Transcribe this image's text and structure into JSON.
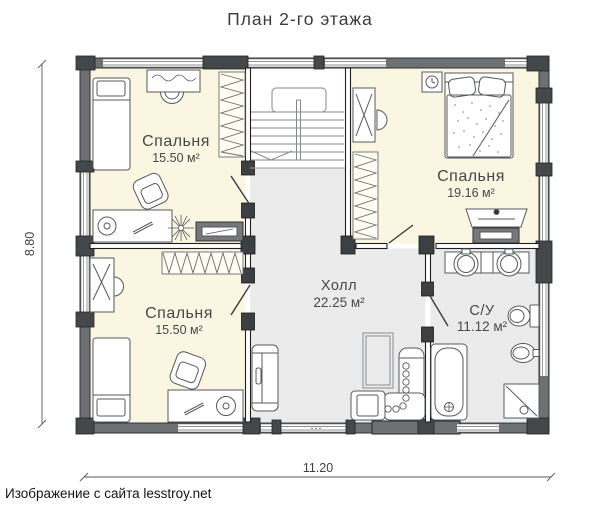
{
  "title": "План 2-го этажа",
  "footer": "Изображение с сайта lesstroy.net",
  "dimensions": {
    "height_m": "8.80",
    "width_m": "11.20"
  },
  "rooms": {
    "bedroom_top_left": {
      "name": "Спальня",
      "area": "15.50 м²"
    },
    "bedroom_top_right": {
      "name": "Спальня",
      "area": "19.16 м²"
    },
    "bedroom_bottom_left": {
      "name": "Спальня",
      "area": "15.50 м²"
    },
    "hall": {
      "name": "Холл",
      "area": "22.25 м²"
    },
    "bathroom": {
      "name": "С/У",
      "area": "11.12 м²"
    }
  },
  "colors": {
    "bedroom_floor": "#faf6e2",
    "hall_floor": "#ebebeb",
    "wall": "#6e7174",
    "post": "#45484b",
    "interior_post": "#3d4043",
    "text": "#45484b"
  }
}
